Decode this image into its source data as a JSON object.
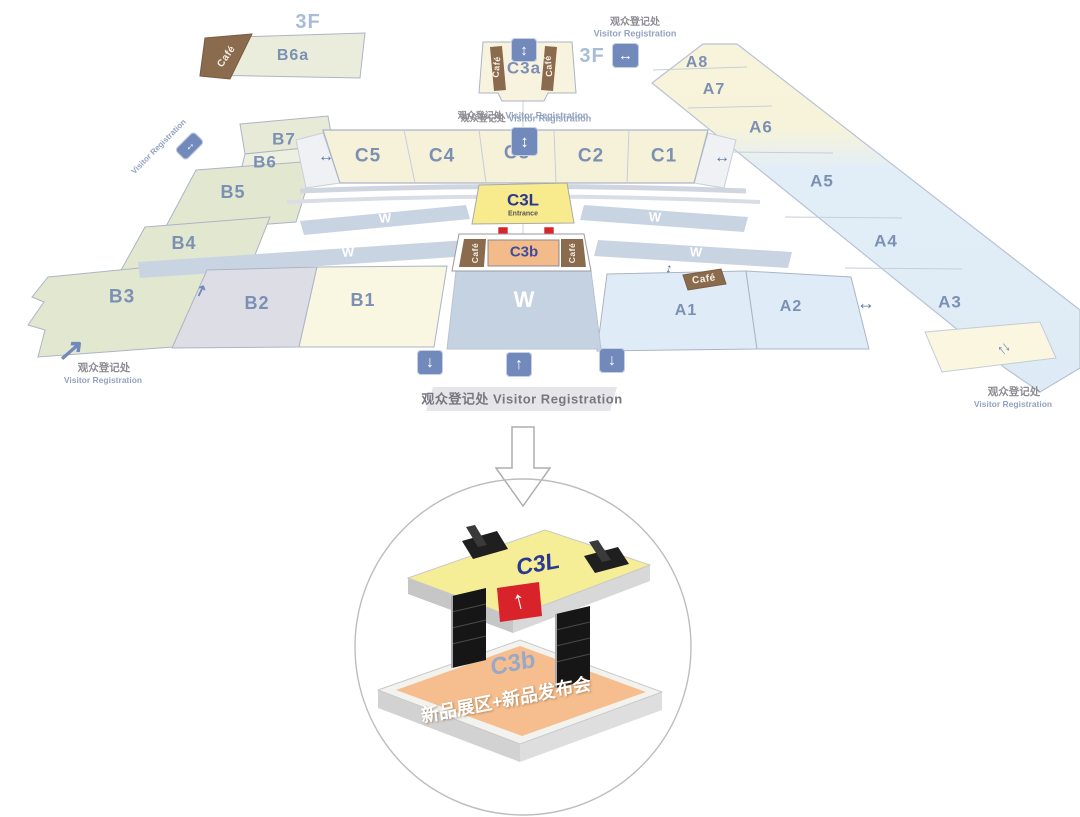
{
  "floor_plan": {
    "floor_label": "3F",
    "registration": {
      "zh": "观众登记处",
      "en": "Visitor Registration"
    },
    "cafe_label": "Café",
    "walkway_label": "W",
    "halls": {
      "b6a": "B6a",
      "c3a": "C3a",
      "c5": "C5",
      "c4": "C4",
      "c3": "C3",
      "c2": "C2",
      "c1": "C1",
      "b7": "B7",
      "b6": "B6",
      "b5": "B5",
      "b4": "B4",
      "b3": "B3",
      "b2": "B2",
      "b1": "B1",
      "a8": "A8",
      "a7": "A7",
      "a6": "A6",
      "a5": "A5",
      "a4": "A4",
      "a3": "A3",
      "a2": "A2",
      "a1": "A1",
      "c3l": "C3L",
      "c3l_entrance": "Entrance",
      "c3b": "C3b"
    }
  },
  "detail_view": {
    "c3l": "C3L",
    "c3b": "C3b",
    "c3b_desc": "新品展区+新品发布会"
  },
  "icons": {
    "up_down": "↕",
    "left_right": "↔",
    "up": "↑",
    "down": "↓",
    "diag_up": "↗"
  },
  "colors": {
    "hall_yellow": "#F6F2D9",
    "hall_blue": "#DFECF7",
    "hall_green": "#E2E7D0",
    "walkway": "#C9D4E3",
    "cafe_brown": "#8A6B4E",
    "icon_blue": "#7289BB",
    "c3l_yellow": "#F8EB8D",
    "c3b_orange": "#F4BB8A",
    "arrow_red": "#D6252B",
    "label_blue": "#7C90B4"
  }
}
